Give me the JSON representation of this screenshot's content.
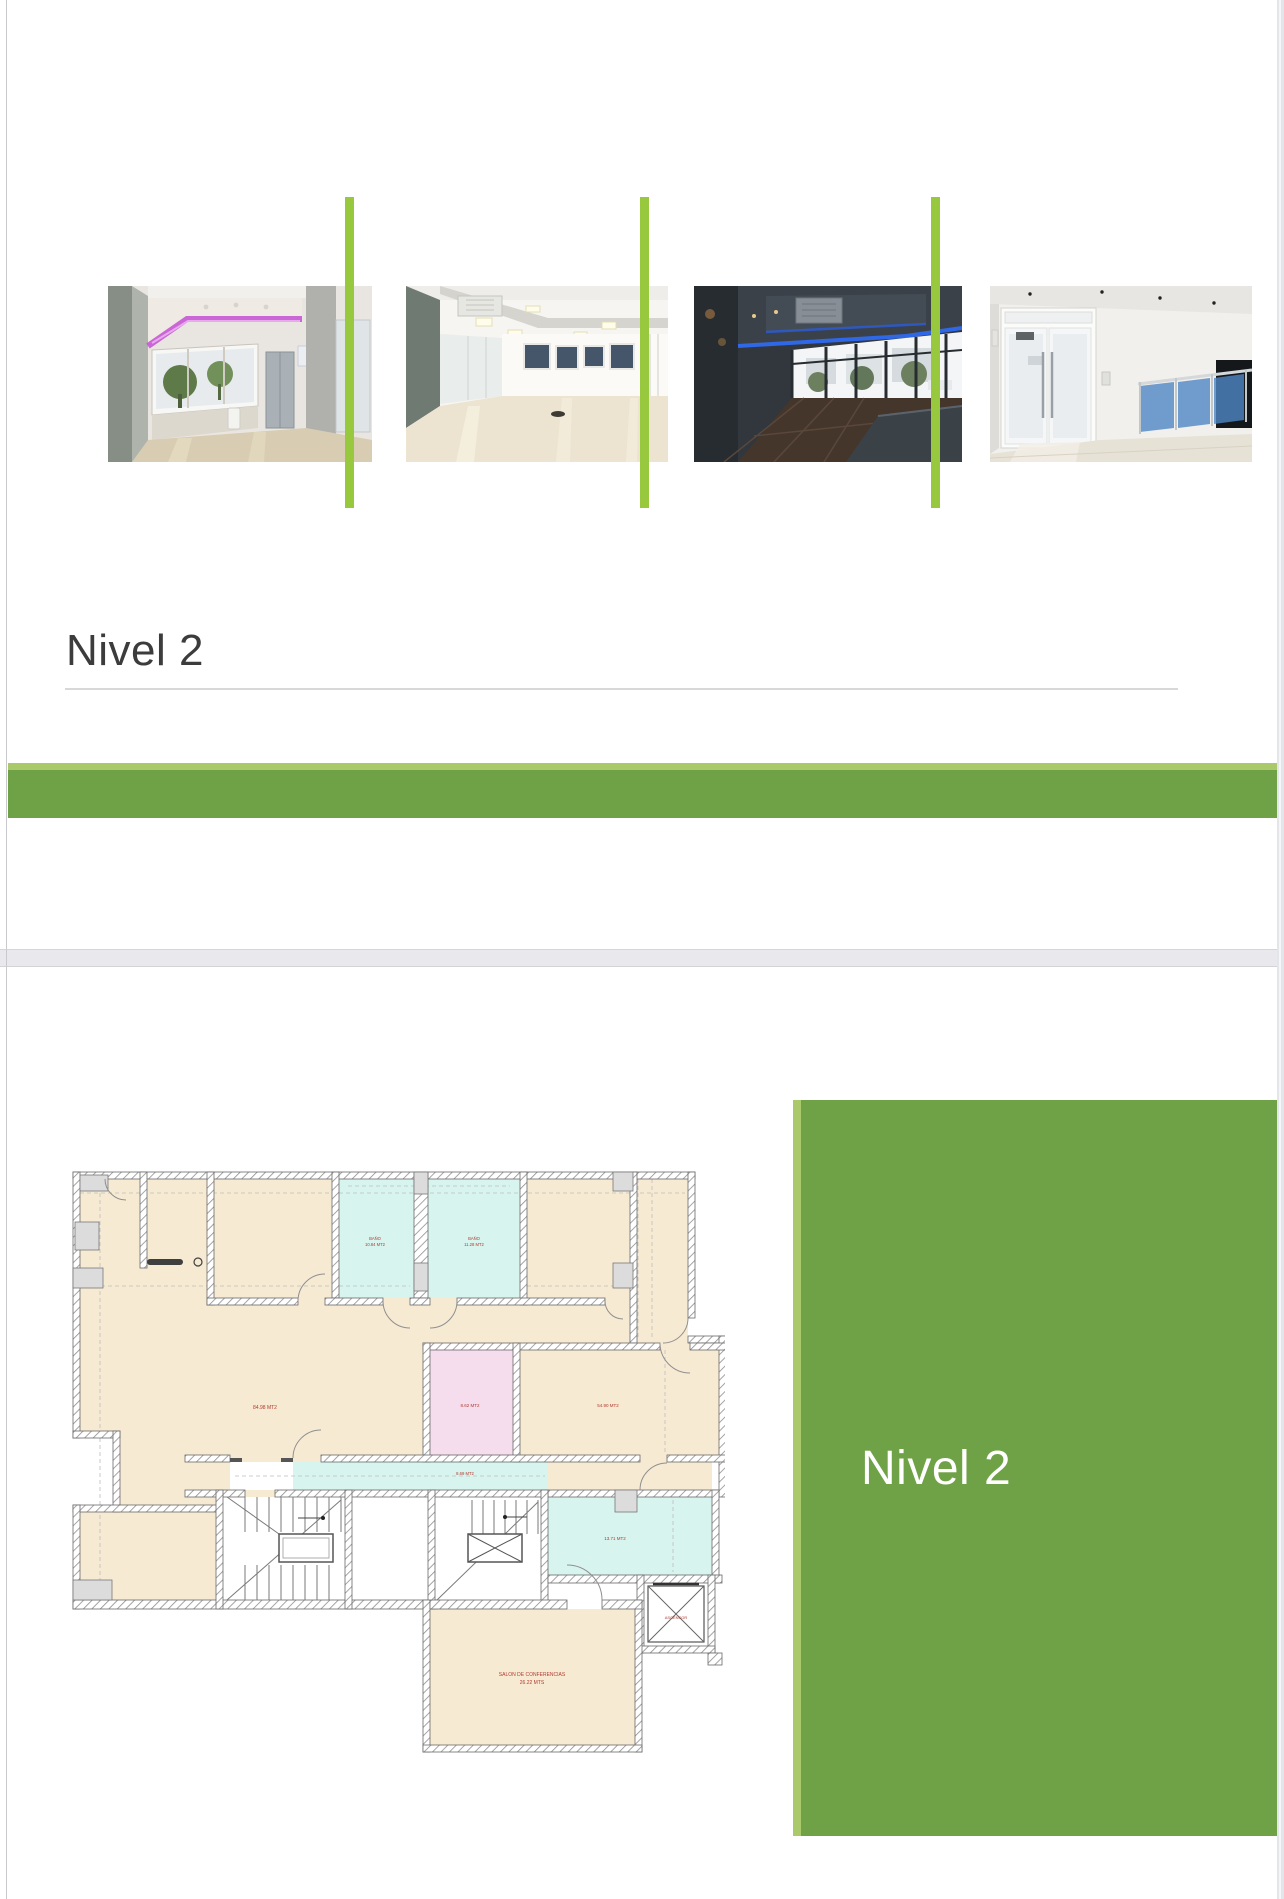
{
  "slide1": {
    "title": "Nivel 2",
    "photos": [
      {
        "name": "interior-purple-cove-window"
      },
      {
        "name": "open-plan-office-bright"
      },
      {
        "name": "room-blue-led-cove"
      },
      {
        "name": "lobby-frosted-door-stairs"
      }
    ]
  },
  "slide2": {
    "panel_title": "Nivel 2",
    "floorplan": {
      "labels": {
        "bano1_line1": "BAÑO",
        "bano1_line2": "10.84 MT2",
        "bano2_line1": "BAÑO",
        "bano2_line2": "11.28 MT2",
        "main_room": "84.98 MT2",
        "pink_room": "8.62 MT2",
        "right_room": "54.90 MT2",
        "corridor": "8.69 MT2",
        "teal_room": "13.71 MT2",
        "elevator": "ASCENSOR",
        "conference_line1": "SALON DE CONFERENCIAS",
        "conference_line2": "26.22 MTS"
      }
    }
  },
  "colors": {
    "accent_green": "#6FA246",
    "accent_green_light": "#A9C96A",
    "separator_green": "#98C83E",
    "title_text": "#3C3C3C",
    "panel_text": "#FFFFFF",
    "room_tan": "#F7EAD3",
    "room_teal": "#D8F4EE",
    "room_pink": "#F5DDED",
    "label_red": "#B03A2E"
  }
}
